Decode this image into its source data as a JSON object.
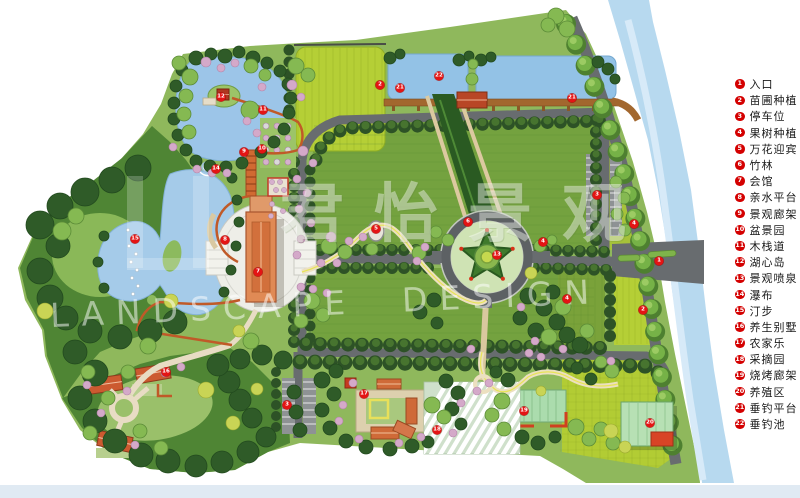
{
  "watermark": {
    "cn": "君怡景观",
    "en": "LANDSCAPE  DESIGN"
  },
  "legend": {
    "items": [
      {
        "n": 1,
        "label": "入口"
      },
      {
        "n": 2,
        "label": "苗圃种植"
      },
      {
        "n": 3,
        "label": "停车位"
      },
      {
        "n": 4,
        "label": "果树种植"
      },
      {
        "n": 5,
        "label": "万花迎宾"
      },
      {
        "n": 6,
        "label": "竹林"
      },
      {
        "n": 7,
        "label": "会馆"
      },
      {
        "n": 8,
        "label": "亲水平台"
      },
      {
        "n": 9,
        "label": "景观廊架"
      },
      {
        "n": 10,
        "label": "盆景园"
      },
      {
        "n": 11,
        "label": "木栈道"
      },
      {
        "n": 12,
        "label": "湖心岛"
      },
      {
        "n": 13,
        "label": "景观喷泉"
      },
      {
        "n": 14,
        "label": "瀑布"
      },
      {
        "n": 15,
        "label": "汀步"
      },
      {
        "n": 16,
        "label": "养生别墅"
      },
      {
        "n": 17,
        "label": "农家乐"
      },
      {
        "n": 18,
        "label": "采摘园"
      },
      {
        "n": 19,
        "label": "烧烤廊架"
      },
      {
        "n": 20,
        "label": "养殖区"
      },
      {
        "n": 21,
        "label": "垂钓平台"
      },
      {
        "n": 22,
        "label": "垂钓池"
      }
    ]
  },
  "map": {
    "markers": [
      {
        "n": 1,
        "x": 659,
        "y": 261
      },
      {
        "n": 2,
        "x": 380,
        "y": 85
      },
      {
        "n": 2,
        "x": 643,
        "y": 310
      },
      {
        "n": 3,
        "x": 287,
        "y": 405
      },
      {
        "n": 3,
        "x": 597,
        "y": 195
      },
      {
        "n": 4,
        "x": 543,
        "y": 242
      },
      {
        "n": 4,
        "x": 567,
        "y": 299
      },
      {
        "n": 4,
        "x": 634,
        "y": 224
      },
      {
        "n": 5,
        "x": 376,
        "y": 229
      },
      {
        "n": 6,
        "x": 468,
        "y": 222
      },
      {
        "n": 7,
        "x": 258,
        "y": 272
      },
      {
        "n": 8,
        "x": 225,
        "y": 240
      },
      {
        "n": 9,
        "x": 244,
        "y": 152
      },
      {
        "n": 10,
        "x": 262,
        "y": 149
      },
      {
        "n": 11,
        "x": 263,
        "y": 110
      },
      {
        "n": 12,
        "x": 221,
        "y": 97
      },
      {
        "n": 13,
        "x": 497,
        "y": 255
      },
      {
        "n": 14,
        "x": 216,
        "y": 169
      },
      {
        "n": 15,
        "x": 135,
        "y": 239
      },
      {
        "n": 16,
        "x": 166,
        "y": 372
      },
      {
        "n": 17,
        "x": 364,
        "y": 394
      },
      {
        "n": 18,
        "x": 437,
        "y": 430
      },
      {
        "n": 19,
        "x": 524,
        "y": 411
      },
      {
        "n": 20,
        "x": 650,
        "y": 423
      },
      {
        "n": 21,
        "x": 400,
        "y": 88
      },
      {
        "n": 21,
        "x": 572,
        "y": 98
      },
      {
        "n": 22,
        "x": 439,
        "y": 76
      }
    ]
  },
  "colors": {
    "legend_red": "#d40000",
    "marker_red": "#e41414",
    "water": "#a9cbe8",
    "river": "#b7d9ef",
    "lawn": "#8fb85c",
    "lawn_dark": "#74a23f",
    "field_bright": "#b5cf36",
    "road_gray": "#686c6f",
    "hedge_green": "#2d5226",
    "tree_green": "#85b952",
    "building_orange": "#d9824f",
    "roof_red": "#c53a20",
    "path_cream": "#e4d6b4",
    "water_strip": "#e0eaf3",
    "forest_green": "#4f8534"
  }
}
